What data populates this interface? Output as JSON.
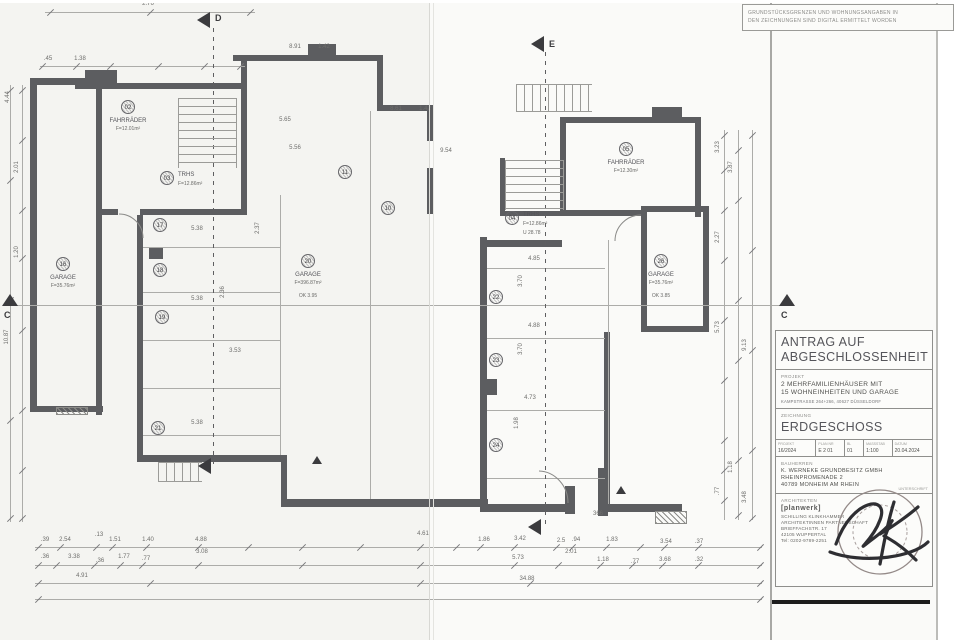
{
  "colors": {
    "wall": "#5c5d60",
    "paper": "#f4f4f1",
    "paper_right": "#fafaf8",
    "thin_line": "#acaca9",
    "ink": "#6e6e6c",
    "heavy_line": "#1d1d1d"
  },
  "scan": {
    "disclaimer": [
      "GRUNDSTÜCKSGRENZEN UND WOHNUNGSANGABEN IN",
      "DEN ZEICHNUNGEN SIND DIGITAL ERMITTELT WORDEN"
    ]
  },
  "title_block": {
    "title_line1": "ANTRAG AUF",
    "title_line2": "ABGESCHLOSSENHEIT",
    "projekt_label": "PROJEKT",
    "projekt_lines": [
      "2 MEHRFAMILIENHÄUSER MIT",
      "15 WOHNEINHEITEN UND GARAGE"
    ],
    "projekt_address": "KAMPSTRASSE 264+266, 40627 DÜSSELDORF",
    "zeichnung_label": "ZEICHNUNG",
    "zeichnung_value": "ERDGESCHOSS",
    "meta": [
      {
        "label": "PROJEKT",
        "value": "16/2024"
      },
      {
        "label": "PLAN NR",
        "value": "E 2 01"
      },
      {
        "label": "BL",
        "value": "01"
      },
      {
        "label": "MASSSTAB",
        "value": "1:100"
      },
      {
        "label": "DATUM",
        "value": "20.04.2024"
      }
    ],
    "bauherren_label": "BAUHERREN",
    "bauherren_lines": [
      "K. WERNEKE GRUNDBESITZ GMBH",
      "RHEINPROMENADE 2",
      "40789 MONHEIM AM RHEIN"
    ],
    "unterschrift": "UNTERSCHRIFT",
    "architekten_label": "ARCHITEKTEN",
    "logo": "[planwerk]",
    "architekt_lines": [
      "SCHILLING KLINKHAMMER",
      "ARCHITEKTINNEN PARTNERSCHAFT",
      "BRIEFFACHSTR. 17",
      "42105 WUPPERTAL",
      "Tel: 0202-9789-2251"
    ]
  },
  "plan": {
    "rooms": [
      {
        "num": "02",
        "name": "FAHRRÄDER",
        "area": "F=12.01m²",
        "extra": "",
        "x": 128,
        "y": 107,
        "side": 0
      },
      {
        "num": "03",
        "name": "TRHS",
        "area": "F=12.86m²",
        "extra": "",
        "x": 167,
        "y": 178,
        "side": 1
      },
      {
        "num": "16",
        "name": "GARAGE",
        "area": "F=35.76m²",
        "extra": "",
        "x": 63,
        "y": 264,
        "side": 0
      },
      {
        "num": "20",
        "name": "GARAGE",
        "area": "F=396.87m²",
        "extra": "OK 3.95",
        "x": 308,
        "y": 261,
        "side": 0
      },
      {
        "num": "04",
        "name": "TRHS",
        "area": "F=12.86m²",
        "extra": "U 28.78",
        "x": 512,
        "y": 218,
        "side": 1
      },
      {
        "num": "05",
        "name": "FAHRRÄDER",
        "area": "F=12.30m²",
        "extra": "",
        "x": 626,
        "y": 149,
        "side": 0
      },
      {
        "num": "26",
        "name": "GARAGE",
        "area": "F=35.76m²",
        "extra": "OK 3.85",
        "x": 661,
        "y": 261,
        "side": 0
      }
    ],
    "spots": [
      {
        "num": "17",
        "x": 160,
        "y": 225
      },
      {
        "num": "18",
        "x": 160,
        "y": 270
      },
      {
        "num": "19",
        "x": 162,
        "y": 317
      },
      {
        "num": "21",
        "x": 158,
        "y": 428
      },
      {
        "num": "11",
        "x": 345,
        "y": 172
      },
      {
        "num": "10",
        "x": 388,
        "y": 208
      },
      {
        "num": "22",
        "x": 496,
        "y": 297
      },
      {
        "num": "23",
        "x": 496,
        "y": 360
      },
      {
        "num": "24",
        "x": 496,
        "y": 445
      }
    ],
    "sections": [
      {
        "label": "C",
        "x": 4,
        "y": 310
      },
      {
        "label": "C",
        "x": 781,
        "y": 310
      },
      {
        "label": "D",
        "x": 215,
        "y": 13
      },
      {
        "label": "E",
        "x": 549,
        "y": 39
      }
    ],
    "notes": [
      {
        "t": "366",
        "x": 598,
        "y": 514
      }
    ],
    "dims": [
      [
        "2.76",
        148,
        4,
        0
      ],
      [
        ".45",
        48,
        59,
        0
      ],
      [
        "1.38",
        80,
        59,
        0
      ],
      [
        "8.91",
        295,
        47,
        0
      ],
      [
        "1.42",
        324,
        47,
        0
      ],
      [
        "8.61",
        396,
        109,
        0
      ],
      [
        "1.42",
        425,
        109,
        0
      ],
      [
        "9.54",
        446,
        151,
        0
      ],
      [
        "5.65",
        285,
        120,
        0
      ],
      [
        "5.56",
        295,
        148,
        0
      ],
      [
        "5.38",
        197,
        229,
        0
      ],
      [
        "2.37",
        258,
        228,
        1
      ],
      [
        "5.38",
        197,
        299,
        0
      ],
      [
        "2.36",
        223,
        292,
        1
      ],
      [
        "5.38",
        197,
        423,
        0
      ],
      [
        "3.53",
        235,
        351,
        0
      ],
      [
        "4.85",
        534,
        259,
        0
      ],
      [
        "3.70",
        521,
        281,
        1
      ],
      [
        "4.88",
        534,
        326,
        0
      ],
      [
        "3.70",
        521,
        349,
        1
      ],
      [
        "4.73",
        530,
        398,
        0
      ],
      [
        "1.98",
        517,
        423,
        1
      ],
      [
        "4.44",
        8,
        97,
        1
      ],
      [
        "2.01",
        17,
        167,
        1
      ],
      [
        "1.20",
        17,
        252,
        1
      ],
      [
        "10.87",
        7,
        337,
        1
      ],
      [
        "3.23",
        718,
        147,
        1
      ],
      [
        "3.87",
        731,
        167,
        1
      ],
      [
        "2.27",
        718,
        237,
        1
      ],
      [
        "5.73",
        718,
        327,
        1
      ],
      [
        "9.13",
        745,
        345,
        1
      ],
      [
        "1.18",
        731,
        467,
        1
      ],
      [
        ".77",
        718,
        491,
        1
      ],
      [
        "3.48",
        745,
        497,
        1
      ],
      [
        ".39",
        45,
        540,
        0
      ],
      [
        "2.54",
        65,
        540,
        0
      ],
      [
        ".13",
        99,
        535,
        0
      ],
      [
        "1.51",
        115,
        540,
        0
      ],
      [
        "1.40",
        148,
        540,
        0
      ],
      [
        "4.88",
        201,
        540,
        0
      ],
      [
        "3.08",
        202,
        552,
        0
      ],
      [
        "4.61",
        423,
        534,
        0
      ],
      [
        "1.86",
        484,
        540,
        0
      ],
      [
        "3.42",
        520,
        539,
        0
      ],
      [
        "2.5",
        561,
        541,
        0
      ],
      [
        ".94",
        576,
        540,
        0
      ],
      [
        "2.01",
        571,
        552,
        0
      ],
      [
        "1.83",
        612,
        540,
        0
      ],
      [
        "3.54",
        666,
        542,
        0
      ],
      [
        ".37",
        699,
        542,
        0
      ],
      [
        ".36",
        45,
        557,
        0
      ],
      [
        "3.38",
        74,
        557,
        0
      ],
      [
        ".36",
        100,
        561,
        0
      ],
      [
        "1.77",
        124,
        557,
        0
      ],
      [
        ".77",
        146,
        559,
        0
      ],
      [
        "5.73",
        518,
        558,
        0
      ],
      [
        "1.18",
        603,
        560,
        0
      ],
      [
        ".77",
        635,
        562,
        0
      ],
      [
        "3.68",
        665,
        560,
        0
      ],
      [
        ".32",
        699,
        560,
        0
      ],
      [
        "4.91",
        82,
        576,
        0
      ],
      [
        "34.88",
        527,
        579,
        0
      ]
    ]
  }
}
